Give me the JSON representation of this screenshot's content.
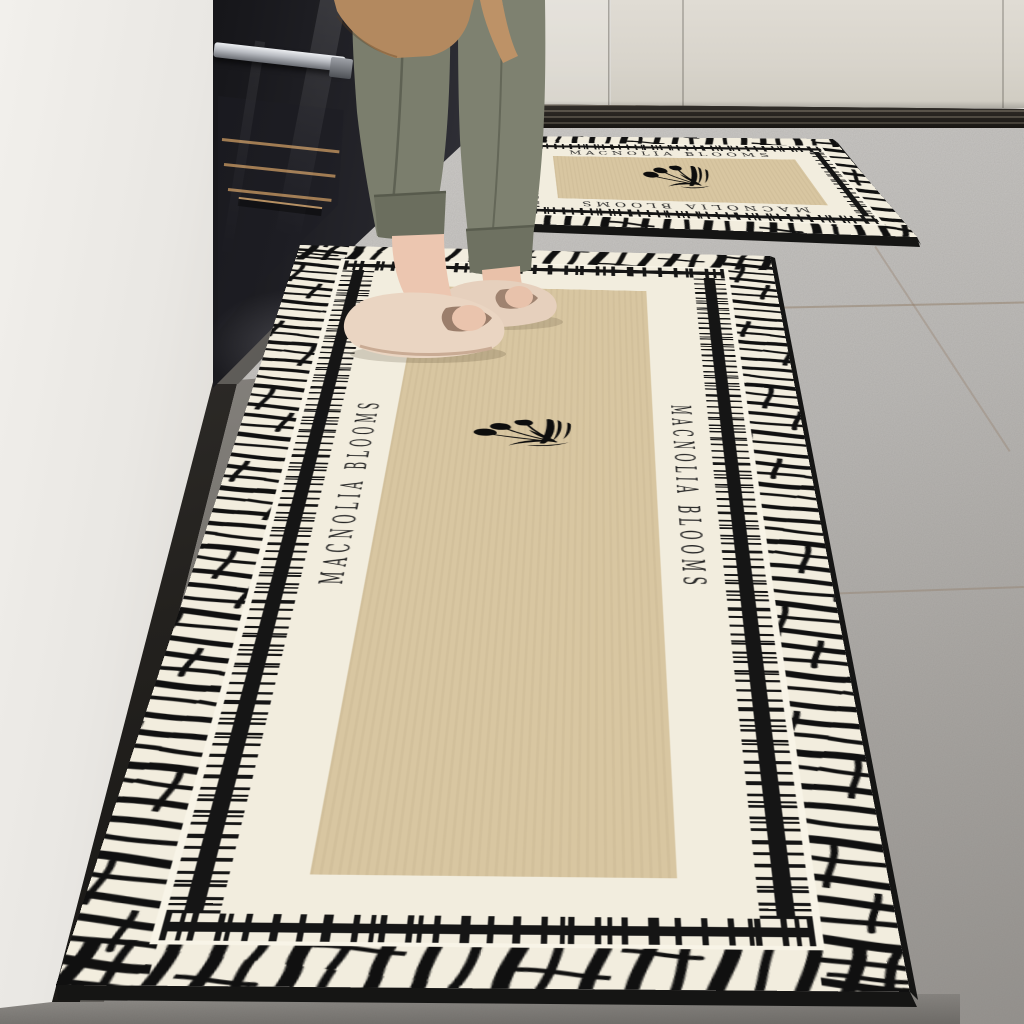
{
  "scene": {
    "description": "Kitchen product photo: person in slippers standing on a long runner mat beside a black built-in oven; matching small mat behind",
    "palette": {
      "wall": "#e9e6e2",
      "cabinets": "#d8d4cb",
      "plinth": "#211c15",
      "floor_light": "#d2d0cd",
      "floor_dark": "#95928e",
      "oven_black": "#17171a"
    },
    "person": {
      "trousers_color": "#7b7e6d",
      "apron_color": "#b3895f",
      "slippers_color": "#ead5c2",
      "skin_color": "#ecc6b0"
    }
  },
  "mats": {
    "brand_text": "MACNOLIA BLOOMS",
    "motif": "black tulip bouquet silhouette",
    "border_styles": [
      "zebra brush-stroke outer border",
      "barcode stripe with cross ticks",
      "cream serif text band",
      "khaki center field"
    ],
    "colors": {
      "cream": "#f2edde",
      "khaki_center": "#d8c6a1",
      "pattern_black": "#151515",
      "white_gap": "#f8f4e7",
      "edge_base": "#151514"
    },
    "items": [
      {
        "name": "long runner mat"
      },
      {
        "name": "small mat"
      }
    ]
  }
}
